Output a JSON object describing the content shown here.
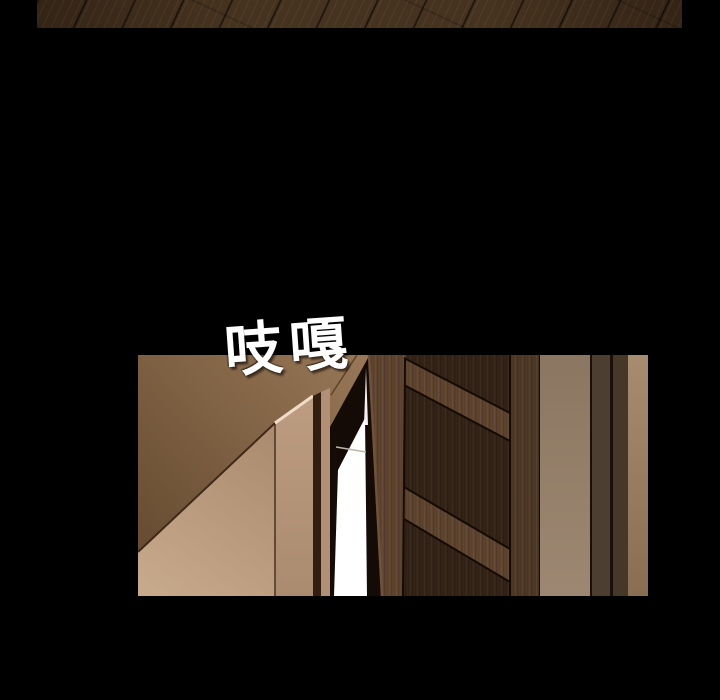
{
  "page": {
    "background": "#000000"
  },
  "sfx": {
    "text": "吱嘎",
    "color": "#ffffff"
  },
  "palette": {
    "bg": "#000000",
    "sfx": "#ffffff",
    "floor_wood": "#46331f",
    "floor_wood_dark": "#342416",
    "ceiling": "#977756",
    "ceiling_deep": "#684d32",
    "wall_lower": "#ab8b6e",
    "wall_lower_light": "#c7a98c",
    "jamb_face_top": "#bd9c81",
    "jamb_face_bottom": "#ab8b6f",
    "jamb_highlight": "#efdcc7",
    "jamb_corner": "#321e11",
    "jamb_side": "#b29076",
    "doorway_shadow": "#140a06",
    "light_beam": "#ffffff",
    "light_floor_line": "#bdb5a9",
    "door_wood": "#5f452f",
    "door_wood_dark": "#4f3926",
    "door_panel": "#342317",
    "door_edge_line": "#140b05",
    "door_edge_highlight": "#70513a",
    "wall_near_top": "#8b7761",
    "wall_near_bottom": "#9d8772",
    "trim_dark": "#4c3e30",
    "trim_darker": "#453828",
    "trim_line": "#1a1009",
    "wall_far_top": "#a88c6f",
    "wall_far_bottom": "#8a6e52"
  }
}
